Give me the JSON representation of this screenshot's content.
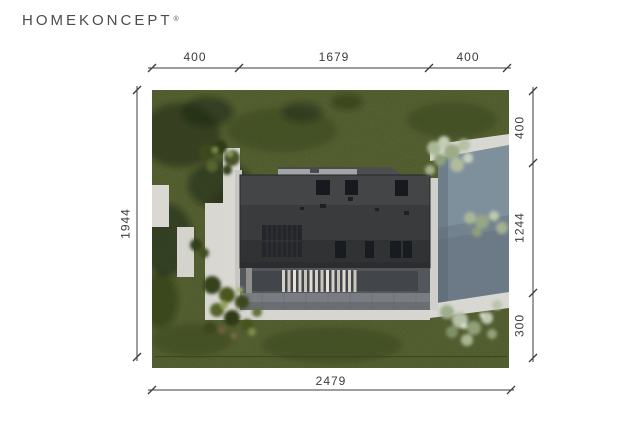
{
  "logo": {
    "text": "HOMEKONCEPT",
    "registered": "®"
  },
  "plan": {
    "dimensions": {
      "top": [
        "400",
        "1679",
        "400"
      ],
      "bottom": [
        "2479"
      ],
      "left": [
        "1944"
      ],
      "right": [
        "400",
        "1244",
        "300"
      ]
    },
    "colors": {
      "grass": "#4a5429",
      "roof": "#3a3b3d",
      "driveway": "#73828f",
      "concrete": "#d8d7d2",
      "terrace": "#797d82",
      "pergola_slat": "#d4d0c7",
      "shrub_light": "#aab795",
      "tree_shadow": "#1c2510",
      "dimension_line": "#3b3b3b",
      "logo_text": "#4c4c4c"
    }
  }
}
